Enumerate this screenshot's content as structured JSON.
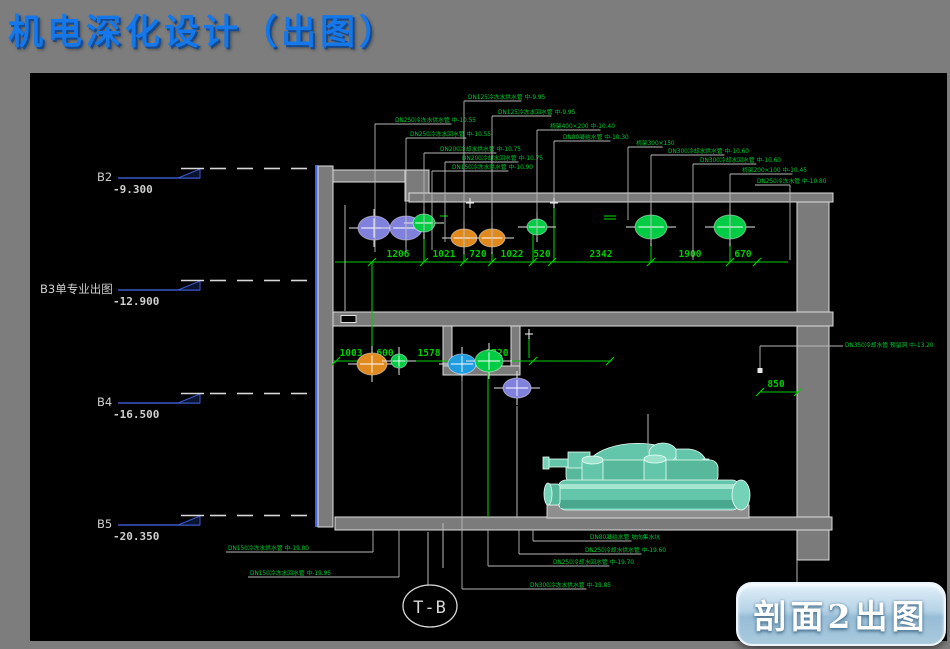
{
  "title": "机电深化设计（出图）",
  "section_button": {
    "label": "剖面2出图"
  },
  "grid_bubble": {
    "label": "T-B",
    "cx": 430,
    "cy": 606
  },
  "colors": {
    "green": "#00cc33",
    "dim_green": "#00cc00",
    "blue_level": "#3c59c8",
    "purple": "#8080dd",
    "orange": "#e08a1e",
    "circle_green": "#00cc44",
    "circle_blue": "#1f9bdf",
    "white_line": "#b8b8b8",
    "level_text": "#cfcfcf"
  },
  "levels": [
    {
      "name": "B2",
      "elevation": "-9.300",
      "y": 178,
      "label_x": 97
    },
    {
      "name": "B3单专业出图",
      "elevation": "-12.900",
      "y": 290,
      "label_x": 40
    },
    {
      "name": "B4",
      "elevation": "-16.500",
      "y": 403,
      "label_x": 97
    },
    {
      "name": "B5",
      "elevation": "-20.350",
      "y": 525,
      "label_x": 97
    }
  ],
  "dimensions": {
    "upper": {
      "y": 262,
      "x1": 335,
      "x2": 788,
      "ticks": [
        372,
        424,
        464,
        492,
        533,
        552,
        651,
        730,
        757
      ],
      "labels": [
        {
          "t": "1206",
          "x": 398
        },
        {
          "t": "1021",
          "x": 444
        },
        {
          "t": "720",
          "x": 478
        },
        {
          "t": "1022",
          "x": 512
        },
        {
          "t": "520",
          "x": 542
        },
        {
          "t": "2342",
          "x": 601
        },
        {
          "t": "1900",
          "x": 690
        },
        {
          "t": "670",
          "x": 743
        }
      ]
    },
    "mid": {
      "y": 361,
      "x1": 333,
      "x2": 612,
      "ticks": [
        336,
        372,
        399,
        462,
        533,
        610
      ],
      "labels": [
        {
          "t": "1003",
          "x": 351
        },
        {
          "t": "600",
          "x": 385
        },
        {
          "t": "1578",
          "x": 429
        },
        {
          "t": "1720",
          "x": 497
        }
      ]
    },
    "offset": {
      "y": 392,
      "x1": 760,
      "x2": 798,
      "ticks": [
        760,
        798
      ],
      "labels": [
        {
          "t": "850",
          "x": 776
        }
      ]
    }
  },
  "pipes": [
    {
      "cx": 374,
      "cy": 228,
      "rx": 16,
      "ry": 12,
      "f": "purple"
    },
    {
      "cx": 406,
      "cy": 228,
      "rx": 16,
      "ry": 12,
      "f": "purple"
    },
    {
      "cx": 424,
      "cy": 223,
      "rx": 11,
      "ry": 9,
      "f": "circle_green"
    },
    {
      "cx": 464,
      "cy": 238,
      "rx": 13,
      "ry": 9,
      "f": "orange"
    },
    {
      "cx": 492,
      "cy": 238,
      "rx": 13,
      "ry": 9,
      "f": "orange"
    },
    {
      "cx": 537,
      "cy": 227,
      "rx": 10,
      "ry": 8,
      "f": "circle_green"
    },
    {
      "cx": 651,
      "cy": 227,
      "rx": 16,
      "ry": 12,
      "f": "circle_green"
    },
    {
      "cx": 730,
      "cy": 227,
      "rx": 16,
      "ry": 12,
      "f": "circle_green"
    },
    {
      "cx": 372,
      "cy": 364,
      "rx": 15,
      "ry": 11,
      "f": "orange"
    },
    {
      "cx": 399,
      "cy": 361,
      "rx": 8,
      "ry": 7,
      "f": "circle_green"
    },
    {
      "cx": 462,
      "cy": 364,
      "rx": 14,
      "ry": 10,
      "f": "circle_blue"
    },
    {
      "cx": 489,
      "cy": 361,
      "rx": 14,
      "ry": 11,
      "f": "circle_green"
    },
    {
      "cx": 517,
      "cy": 388,
      "rx": 14,
      "ry": 10,
      "f": "purple"
    }
  ],
  "annotations": {
    "top": [
      {
        "t": "DN250冷冻水供水管 中-10.55",
        "x": 395,
        "y": 116,
        "lx": 375,
        "by": 252
      },
      {
        "t": "DN250冷冻水回水管 中-10.55",
        "x": 410,
        "y": 130,
        "lx": 406,
        "by": 252
      },
      {
        "t": "DN200冷却水供水管 中-10.75",
        "x": 440,
        "y": 145,
        "lx": 424,
        "by": 234
      },
      {
        "t": "DN125冷冻水供水管 中-9.95",
        "x": 468,
        "y": 93,
        "lx": 464,
        "by": 252
      },
      {
        "t": "DN125冷冻水回水管 中-9.95",
        "x": 498,
        "y": 108,
        "lx": 492,
        "by": 252
      },
      {
        "t": "DN200冷却水回水管 中-10.75",
        "x": 462,
        "y": 154,
        "lx": 445,
        "by": 242
      },
      {
        "t": "DN150冷冻水供水管 中-10.90",
        "x": 452,
        "y": 163,
        "lx": 432,
        "by": 250
      },
      {
        "t": "桥架400×200 中-10.40",
        "x": 550,
        "y": 122,
        "lx": 537,
        "by": 237
      },
      {
        "t": "DN80凝结水管 中-10.30",
        "x": 563,
        "y": 133,
        "lx": 554,
        "by": 205
      },
      {
        "t": "桥架300×150",
        "x": 636,
        "y": 139,
        "lx": 628,
        "by": 220
      },
      {
        "t": "DN300冷却水供水管 中-10.60",
        "x": 668,
        "y": 147,
        "lx": 651,
        "by": 243
      },
      {
        "t": "DN300冷却水回水管 中-10.60",
        "x": 700,
        "y": 156,
        "lx": 693,
        "by": 260
      },
      {
        "t": "桥架200×100 中-10.45",
        "x": 742,
        "y": 166,
        "lx": 730,
        "by": 243
      },
      {
        "t": "DN250冷冻水管 中-10.80",
        "x": 757,
        "y": 177,
        "lx": 790,
        "by": 260,
        "dir": "right"
      }
    ],
    "bottom": [
      {
        "t": "DN150冷冻水供水管 中-19.80",
        "x": 228,
        "y": 544,
        "lx": 373,
        "by": 530,
        "dir": "right"
      },
      {
        "t": "DN150冷冻水回水管 中-19.95",
        "x": 250,
        "y": 569,
        "lx": 399,
        "by": 530,
        "dir": "right"
      },
      {
        "t": "DN80凝结水管 坡向集水坑",
        "x": 590,
        "y": 533,
        "lx": 533,
        "by": 530,
        "dir": "left"
      },
      {
        "t": "DN250冷却水供水管 中-19.60",
        "x": 585,
        "y": 546,
        "lx": 519,
        "by": 530,
        "dir": "left"
      },
      {
        "t": "DN250冷却水回水管 中-19.70",
        "x": 553,
        "y": 558,
        "lx": 488,
        "by": 530,
        "dir": "left"
      },
      {
        "t": "DN300冷冻水供水管 中-19.85",
        "x": 530,
        "y": 581,
        "lx": 462,
        "by": 377,
        "dir": "left"
      }
    ],
    "right": {
      "t": "DN350冷却水管 预留洞 中-13.20",
      "x": 845,
      "y": 341,
      "lx": 760,
      "by": 368
    }
  },
  "extra_lines": {
    "white": [
      [
        345,
        205,
        345,
        311
      ],
      [
        428,
        532,
        428,
        585
      ],
      [
        443,
        523,
        443,
        568
      ],
      [
        797,
        560,
        797,
        582
      ],
      [
        517,
        406,
        517,
        517
      ],
      [
        651,
        204,
        651,
        248
      ],
      [
        730,
        204,
        730,
        248
      ],
      [
        648,
        414,
        648,
        452
      ]
    ],
    "green": [
      [
        372,
        262,
        372,
        377
      ],
      [
        424,
        232,
        424,
        262
      ],
      [
        464,
        247,
        464,
        262
      ],
      [
        492,
        247,
        492,
        262
      ],
      [
        533,
        234,
        533,
        262
      ],
      [
        554,
        207,
        554,
        262
      ],
      [
        651,
        239,
        651,
        262
      ],
      [
        730,
        239,
        730,
        262
      ],
      [
        488,
        372,
        488,
        517
      ],
      [
        529,
        338,
        529,
        358
      ],
      [
        604,
        216,
        616,
        216
      ],
      [
        604,
        219,
        616,
        219
      ],
      [
        440,
        216,
        448,
        216
      ]
    ]
  },
  "markers": [
    [
      470,
      203
    ],
    [
      554,
      203
    ],
    [
      529,
      334
    ]
  ]
}
